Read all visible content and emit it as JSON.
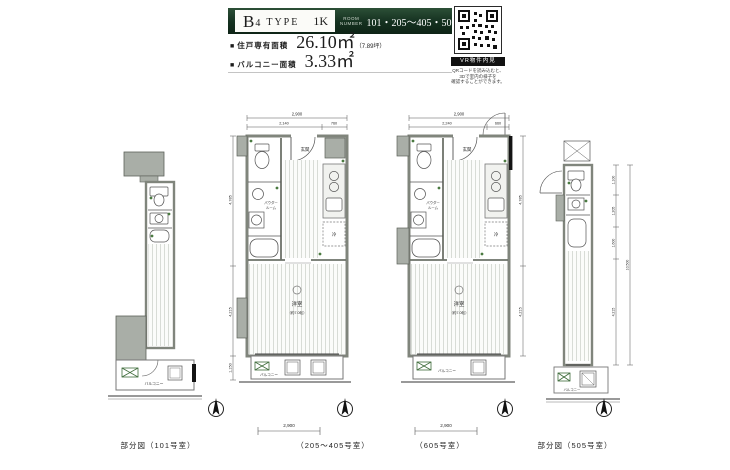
{
  "header": {
    "type_letter": "B",
    "type_number": "4",
    "type_word": "TYPE",
    "plan_type": "1K",
    "room_number_label_1": "ROOM",
    "room_number_label_2": "NUMBER",
    "room_numbers": "101・205〜405・505・605",
    "area1_bullet": "■",
    "area1_label": "住戸専有面積",
    "area1_value": "26.10㎡",
    "area1_note": "（7.89坪）",
    "area2_bullet": "■",
    "area2_label": "バルコニー面積",
    "area2_value": "3.33㎡"
  },
  "qr_panel": {
    "vr_badge": "VR物件内見",
    "caption1": "QRコードを読み込むと、",
    "caption2": "3Dで室内の様子を",
    "caption3": "確認することができます。"
  },
  "labels": {
    "genkan": "玄関",
    "powder1": "パウダー",
    "powder2": "ルーム",
    "room": "洋室",
    "room_size": "（約7.0帖）",
    "balcony": "バルコニー",
    "fridge": "冷"
  },
  "dims": {
    "b_top_total": "2,900",
    "b_top_main": "2,140",
    "b_top_sub": "760",
    "b_left_upper": "4,785",
    "b_left_lower": "4,215",
    "b_left_balcony": "1,150",
    "b_bottom": "2,900",
    "c_top_total": "2,900",
    "c_top_main": "2,240",
    "c_top_sub": "660",
    "c_right_upper": "4,785",
    "c_right_lower": "4,215",
    "c_bottom": "2,900",
    "d_total": "10,500",
    "d_seg1": "1,100",
    "d_seg2": "1,205",
    "d_seg3": "1,600",
    "d_seg4": "4,215"
  },
  "captions": {
    "plan_a": "部分図（101号室）",
    "plan_b": "（205〜405号室）",
    "plan_c": "（605号室）",
    "plan_d": "部分図（505号室）"
  }
}
